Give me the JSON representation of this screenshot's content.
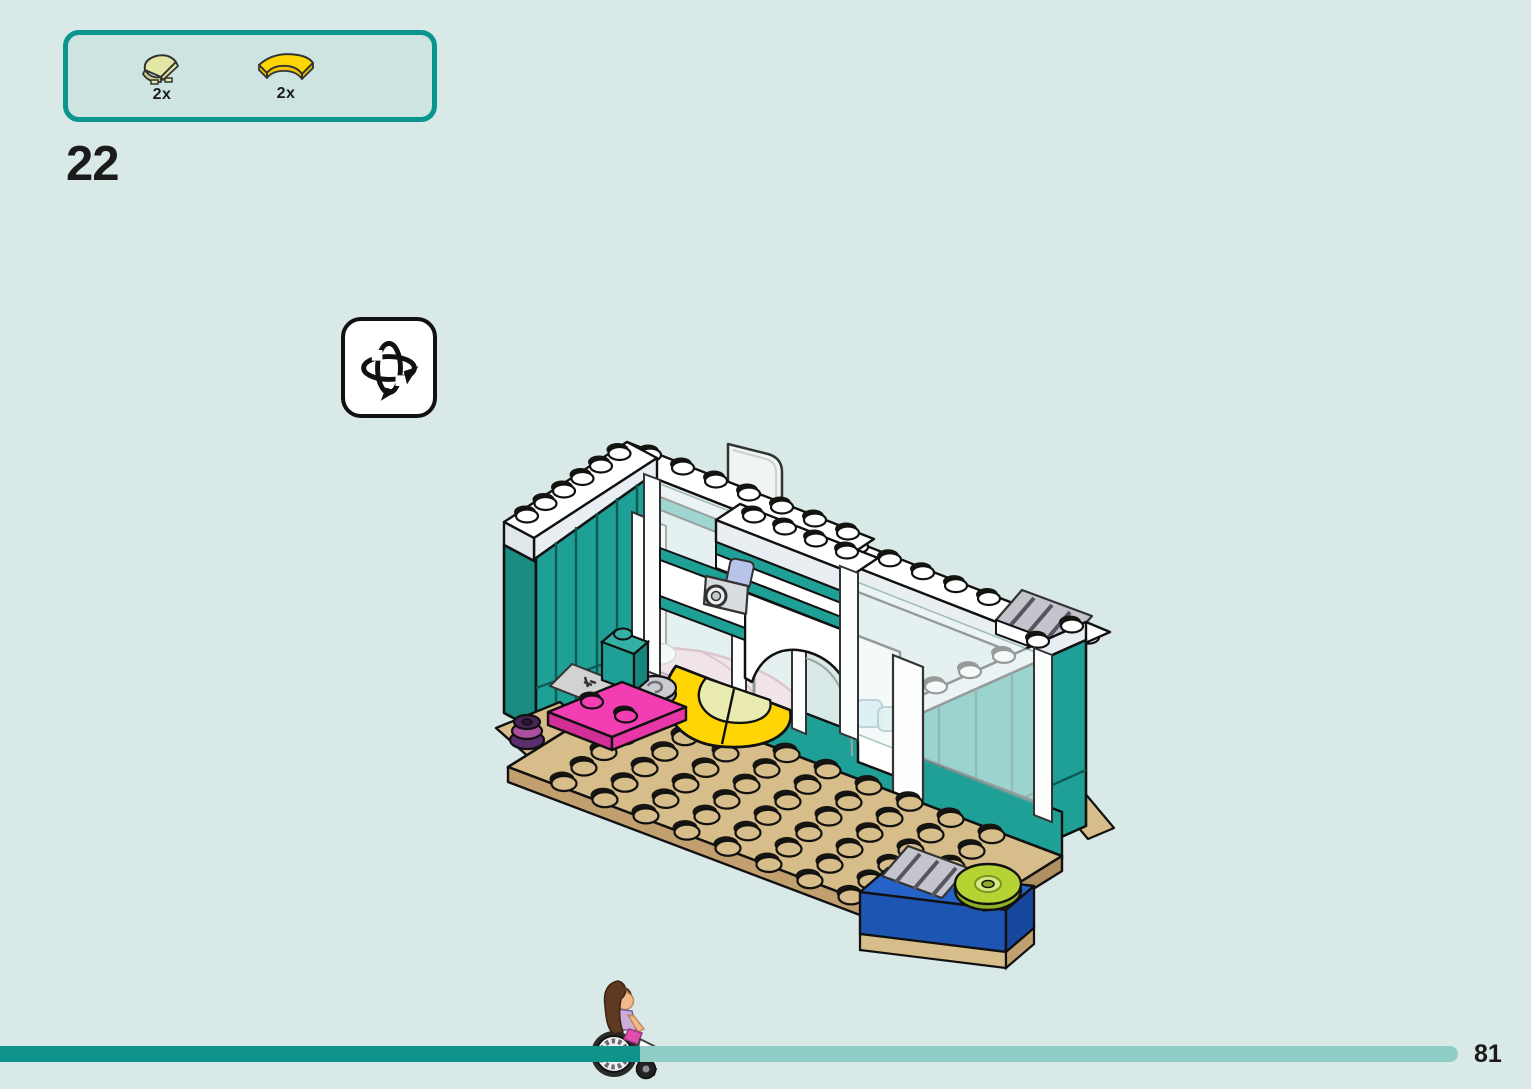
{
  "page": {
    "number": "81",
    "step_number": "22",
    "background_color": "#d8e9e7"
  },
  "parts_callout": {
    "border_color": "#0a968e",
    "fill_color": "#cde4e0",
    "parts": [
      {
        "name": "quarter-round-tile-bright-light-yellow",
        "color": "#e4e6a5",
        "count_label": "2x"
      },
      {
        "name": "curved-macaroni-tile-yellow",
        "color": "#ffd504",
        "count_label": "2x"
      }
    ]
  },
  "rotate_hint": {
    "icon_name": "rotate-model-3d-icon"
  },
  "illustration": {
    "name": "building-step-preview",
    "description": "Isometric view of a partially built LEGO Friends room: teal walls capped with white stud rows, tan studded floor plate, sliding glass door with pink bed behind, white archway with teal stripes and a security camera, yellow half-round rug with pale quarter tiles, magenta plate, dark purple flower stack, grey round tile, clear door panel on top, right teal wall with grey grille pieces, blue brick with lime disc",
    "colors": {
      "wall_teal": "#1fa096",
      "floor_tan": "#d6bd8a",
      "rug_yellow": "#ffd504",
      "rug_pale": "#e9ebb0",
      "plate_magenta": "#f23eb2",
      "brick_blue": "#2563c8",
      "disc_lime": "#b5d433",
      "bed_pink": "#f8c9d9",
      "flower_purple": "#5a2d6e"
    }
  },
  "progress": {
    "completed_color": "#10938d",
    "remaining_color": "#8fcec7",
    "completed_fraction": 0.44,
    "marker_name": "minidoll-in-wheelchair"
  }
}
